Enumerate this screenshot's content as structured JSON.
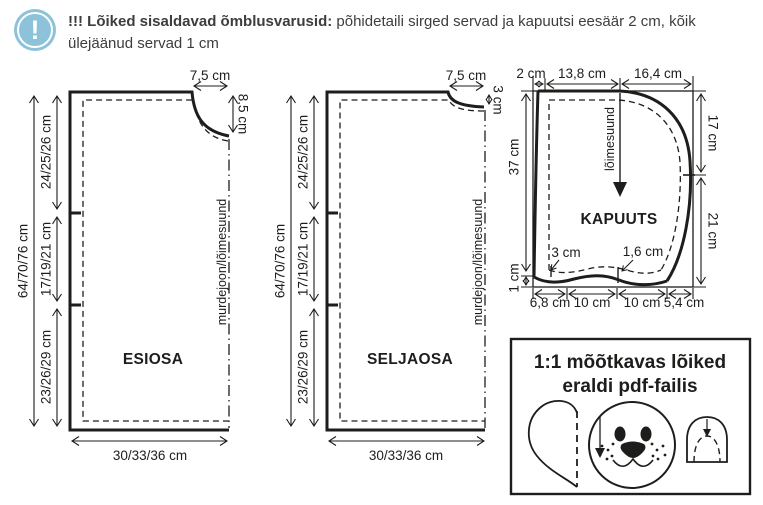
{
  "header": {
    "icon_glyph": "!",
    "alert_bold": "!!! Lõiked sisaldavad õmblusvarusid:",
    "alert_rest": "põhidetaili sirged servad ja kapuutsi eesäär 2 cm, kõik ülejäänud servad 1 cm"
  },
  "colors": {
    "accent_blue": "#8cc3da",
    "ink": "#1d1d1b",
    "text": "#3d3d3c"
  },
  "esiosa": {
    "name": "ESIOSA",
    "total_height": "64/70/76 cm",
    "section_top": "24/25/26 cm",
    "section_middle": "17/19/21 cm",
    "section_bottom": "23/26/29 cm",
    "neck_width": "7,5 cm",
    "neck_depth": "8,5 cm",
    "fold_grain_label": "murdejoon/lõimesuund",
    "bottom_width": "30/33/36 cm"
  },
  "seljaosa": {
    "name": "SELJAOSA",
    "total_height": "64/70/76 cm",
    "section_top": "24/25/26 cm",
    "section_middle": "17/19/21 cm",
    "section_bottom": "23/26/29 cm",
    "neck_width": "7,5 cm",
    "neck_depth": "3 cm",
    "fold_grain_label": "murdejoon/lõimesuund",
    "bottom_width": "30/33/36 cm"
  },
  "kapuuts": {
    "name": "KAPUUTS",
    "grain_label": "lõimesuund",
    "top_seam": "2 cm",
    "top_middle": "13,8 cm",
    "top_right": "16,4 cm",
    "left_height": "37 cm",
    "right_upper": "17 cm",
    "right_lower": "21 cm",
    "hem_left": "1 cm",
    "corner_mark": "3 cm",
    "dip_mark": "1,6 cm",
    "bottom_1": "6,8 cm",
    "bottom_2": "10 cm",
    "bottom_3": "10 cm",
    "bottom_4": "5,4 cm"
  },
  "info_box": {
    "line1": "1:1 mõõtkavas lõiked",
    "line2": "eraldi pdf-failis"
  }
}
